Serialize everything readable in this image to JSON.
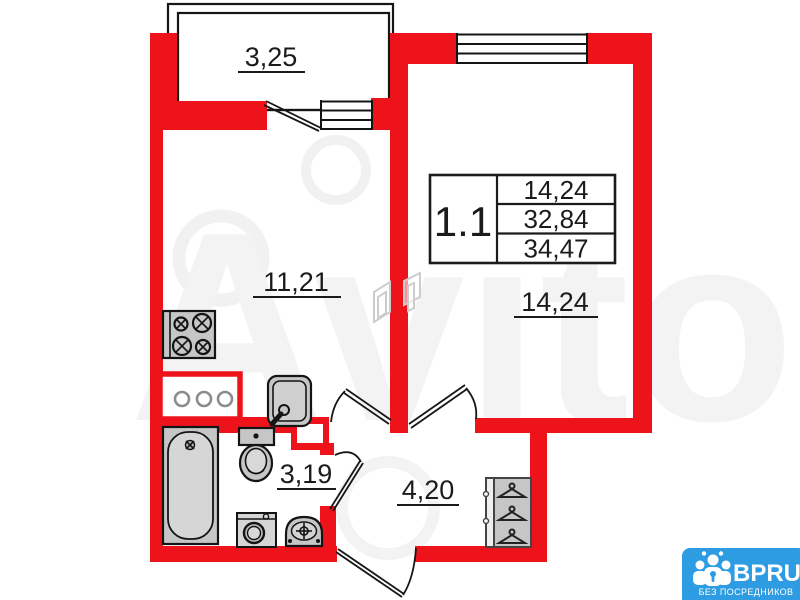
{
  "plan": {
    "labels": {
      "balcony": "3,25",
      "kitchen_living": "11,21",
      "bedroom": "14,24",
      "bathroom": "3,19",
      "hallway": "4,20"
    },
    "info_table": {
      "unit": "1.1",
      "rows": [
        "14,24",
        "32,84",
        "34,47"
      ]
    },
    "colors": {
      "wall_red": "#ee131b",
      "fixture_gray": "#c6c6c6",
      "logo_blue": "#2d9ce3"
    }
  },
  "watermark": {
    "text": "Avito"
  },
  "logo": {
    "brand": "BPRU",
    "tagline": "БЕЗ ПОСРЕДНИКОВ"
  }
}
